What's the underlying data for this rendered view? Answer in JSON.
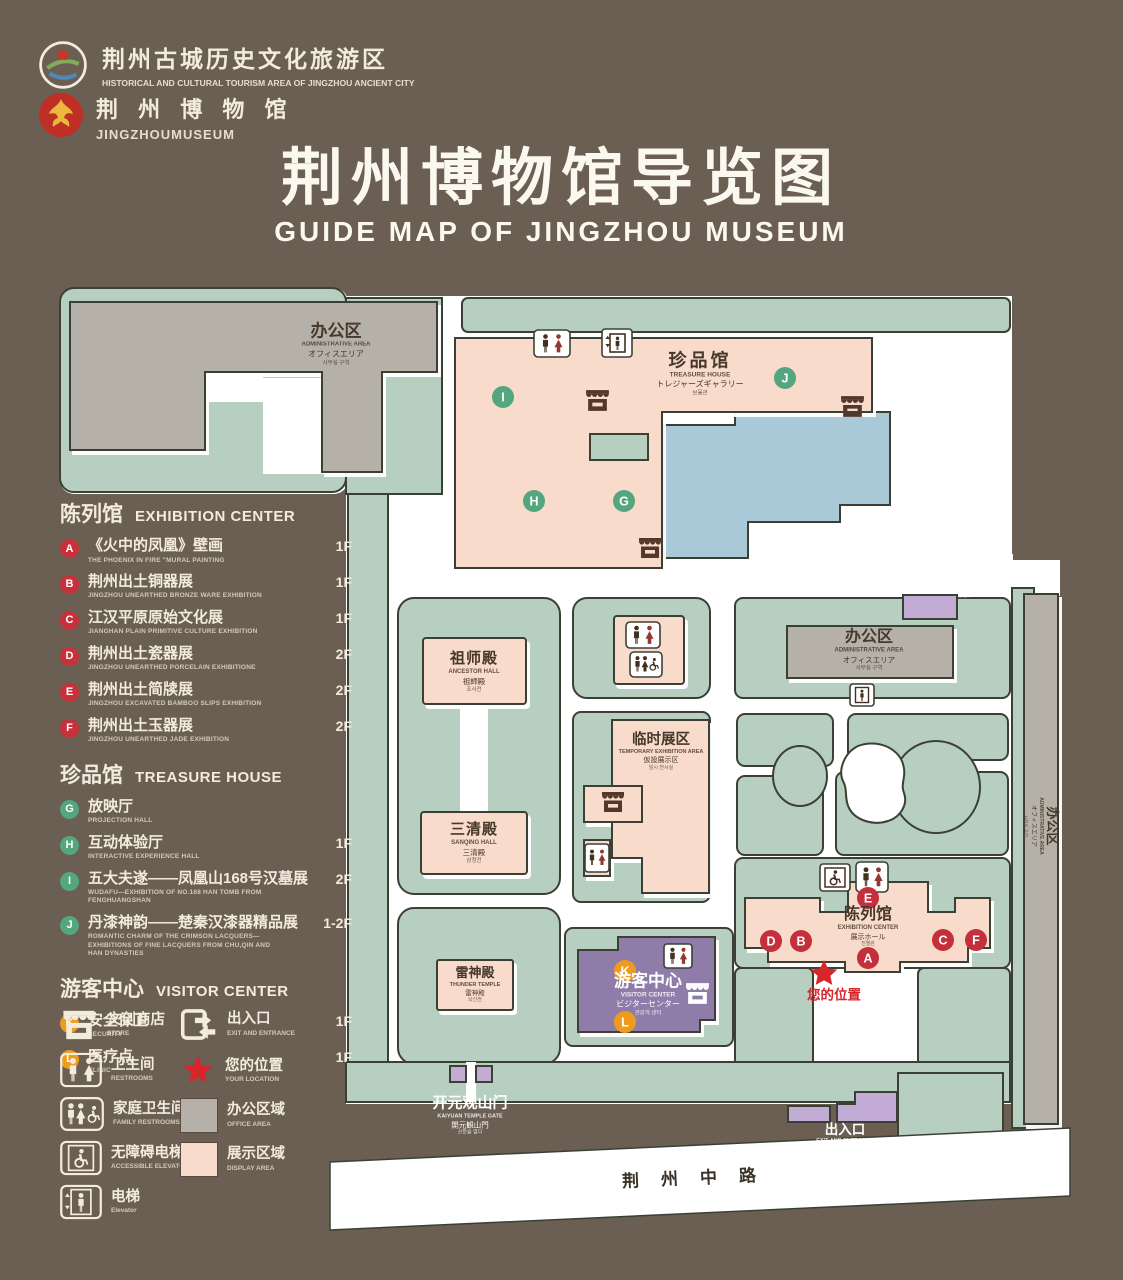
{
  "header": {
    "logo1": {
      "zh": "荆州古城历史文化旅游区",
      "en": "HISTORICAL AND CULTURAL TOURISM AREA OF JINGZHOU ANCIENT CITY"
    },
    "logo2": {
      "zh": "荆 州 博 物 馆",
      "en": "JINGZHOUMUSEUM"
    },
    "title_zh": "荆州博物馆导览图",
    "title_en": "GUIDE MAP OF JINGZHOU MUSEUM"
  },
  "legend": {
    "sections": [
      {
        "zh": "陈列馆",
        "en": "EXHIBITION CENTER",
        "items": [
          {
            "letter": "A",
            "zh": "《火中的凤凰》壁画",
            "en": "THE PHOENIX IN FIRE \"MURAL PAINTING",
            "floor": "1F"
          },
          {
            "letter": "B",
            "zh": "荆州出土铜器展",
            "en": "JINGZHOU UNEARTHED BRONZE WARE EXHIBITION",
            "floor": "1F"
          },
          {
            "letter": "C",
            "zh": "江汉平原原始文化展",
            "en": "JIANGHAN PLAIN PRIMITIVE CULTURE EXHIBITION",
            "floor": "1F"
          },
          {
            "letter": "D",
            "zh": "荆州出土瓷器展",
            "en": "JINGZHOU UNEARTHED PORCELAIN EXHIBITIONE",
            "floor": "2F"
          },
          {
            "letter": "E",
            "zh": "荆州出土简牍展",
            "en": "JINGZHOU EXCAVATED BAMBOO SLIPS EXHIBITION",
            "floor": "2F"
          },
          {
            "letter": "F",
            "zh": "荆州出土玉器展",
            "en": "JINGZHOU UNEARTHED JADE EXHIBITION",
            "floor": "2F"
          }
        ]
      },
      {
        "zh": "珍品馆",
        "en": "TREASURE HOUSE",
        "items": [
          {
            "letter": "G",
            "zh": "放映厅",
            "en": "PROJECTION HALL",
            "floor": "1F"
          },
          {
            "letter": "H",
            "zh": "互动体验厅",
            "en": "INTERACTIVE EXPERIENCE HALL",
            "floor": "1F"
          },
          {
            "letter": "I",
            "zh": "五大夫遂——凤凰山168号汉墓展",
            "en": "WUDAFU—EXHIBITION OF NO.168 HAN TOMB FROM FENGHUANGSHAN",
            "floor": "2F"
          },
          {
            "letter": "J",
            "zh": "丹漆神韵——楚秦汉漆器精品展",
            "en": "ROMANTIC CHARM OF THE CRIMSON LACQUERS—EXHIBITIONS OF FINE LACQUERS FROM CHU,QIN AND HAN DYNASTIES",
            "floor": "1-2F"
          }
        ]
      },
      {
        "zh": "游客中心",
        "en": "VISITOR CENTER",
        "items": [
          {
            "letter": "K",
            "zh": "安全保卫",
            "en": "SECURITY",
            "floor": "1F"
          },
          {
            "letter": "L",
            "zh": "医疗点",
            "en": "CLINIC",
            "floor": "1F"
          }
        ]
      }
    ],
    "facilities": [
      {
        "zh": "文创商店",
        "en": "STORE"
      },
      {
        "zh": "出入口",
        "en": "EXIT AND ENTRANCE"
      },
      {
        "zh": "卫生间",
        "en": "RESTROOMS"
      },
      {
        "zh": "您的位置",
        "en": "YOUR LOCATION"
      },
      {
        "zh": "家庭卫生间",
        "en": "FAMILY RESTROOMS"
      },
      {
        "zh": "办公区域",
        "en": "OFFICE AREA"
      },
      {
        "zh": "无障碍电梯",
        "en": "ACCESSIBLE ELEVATOR"
      },
      {
        "zh": "展示区域",
        "en": "DISPLAY AREA"
      },
      {
        "zh": "电梯",
        "en": "Elevator"
      }
    ]
  },
  "map": {
    "admin": {
      "zh": "办公区",
      "en": "ADMINISTRATIVE AREA",
      "ja": "オフィスエリア",
      "ko": "사무실 구역"
    },
    "treasure": {
      "zh": "珍品馆",
      "en": "TREASURE HOUSE",
      "ja": "トレジャーズギャラリー",
      "ko": "보물관"
    },
    "ancestor": {
      "zh": "祖师殿",
      "en": "ANCESTOR HALL",
      "ja": "祖師殿",
      "ko": "조사전"
    },
    "sanqing": {
      "zh": "三清殿",
      "en": "SANQING HALL",
      "ja": "三清殿",
      "ko": "삼청전"
    },
    "temporary": {
      "zh": "临时展区",
      "en": "TEMPORARY EXHIBITION AREA",
      "ja": "仮設展示区",
      "ko": "임시 전시실"
    },
    "thunder": {
      "zh": "雷神殿",
      "en": "THUNDER TEMPLE",
      "ja": "雷神殿",
      "ko": "뇌신전"
    },
    "visitor": {
      "zh": "游客中心",
      "en": "VISITOR CENTER",
      "ja": "ビジターセンター",
      "ko": "관광객 센터"
    },
    "exhibition": {
      "zh": "陈列馆",
      "en": "EXHIBITION CENTER",
      "ja": "展示ホール",
      "ko": "진열관"
    },
    "gate": {
      "zh": "开元观山门",
      "en": "KAIYUAN TEMPLE GATE",
      "ja": "開元観山門",
      "ko": "산문을 열다"
    },
    "exit": {
      "zh": "出入口",
      "en": "EXIT AND ENTRANCE",
      "ja": "出入口",
      "ko": "출입구"
    },
    "road": "荆州中路",
    "your_location": "您的位置",
    "markers": [
      "A",
      "B",
      "C",
      "D",
      "E",
      "F",
      "G",
      "H",
      "I",
      "J",
      "K",
      "L"
    ]
  },
  "colors": {
    "background": "#6b5e52",
    "map_green": "#b7cfc0",
    "building_pink": "#f8dbca",
    "office_gray": "#b6b1a8",
    "lake_blue": "#a9c9d8",
    "visitor_purple": "#8f7ca9",
    "gate_purple": "#c2abd4",
    "badge_red": "#c8313c",
    "badge_green": "#53a67e",
    "badge_orange": "#ef9c1e",
    "star_red": "#d6252b"
  }
}
